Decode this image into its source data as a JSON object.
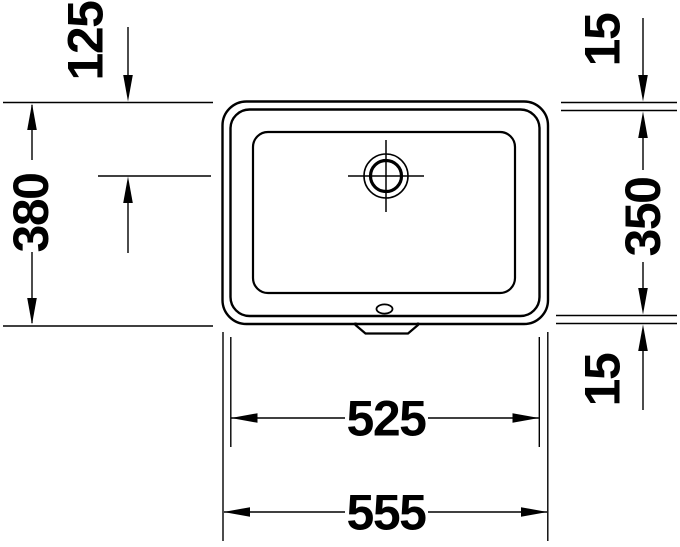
{
  "drawing": {
    "view": "basin top view technical drawing",
    "dimensions": {
      "top_edge_to_drain_center": "125",
      "overall_depth": "380",
      "rim_width_top": "15",
      "inner_depth": "350",
      "rim_width_bottom": "15",
      "inner_width": "525",
      "overall_width": "555"
    },
    "colors": {
      "line": "#000000",
      "background": "#ffffff"
    }
  }
}
